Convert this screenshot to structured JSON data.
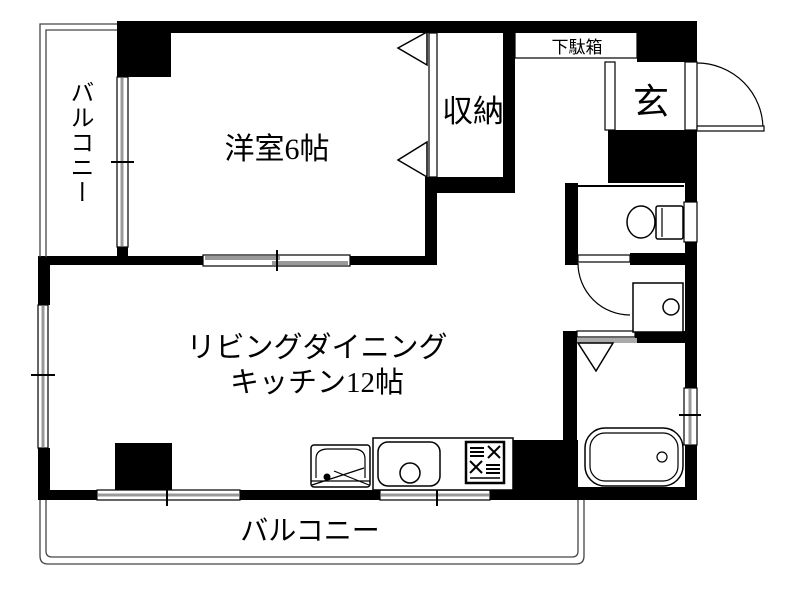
{
  "plan": {
    "labels": {
      "balcony_left": "バルコニー",
      "western_room": "洋室6帖",
      "closet": "収納",
      "shoe_cabinet": "下駄箱",
      "entrance": "玄",
      "ldk_line1": "リビングダイニング",
      "ldk_line2": "キッチン12帖",
      "balcony_bottom": "バルコニー"
    },
    "colors": {
      "wall": "#000000",
      "background": "#ffffff",
      "glass_line": "#999999",
      "railing": "#444444",
      "door_sill": "#aaaaaa",
      "sliding_panel": "#999999"
    },
    "fixtures": [
      "toilet",
      "washbasin",
      "bathtub",
      "kitchen-sink",
      "gas-stove",
      "laundry-pan",
      "entry-door",
      "toilet-door",
      "bath-folding-door",
      "closet-folding-doors",
      "sliding-door",
      "windows"
    ]
  }
}
